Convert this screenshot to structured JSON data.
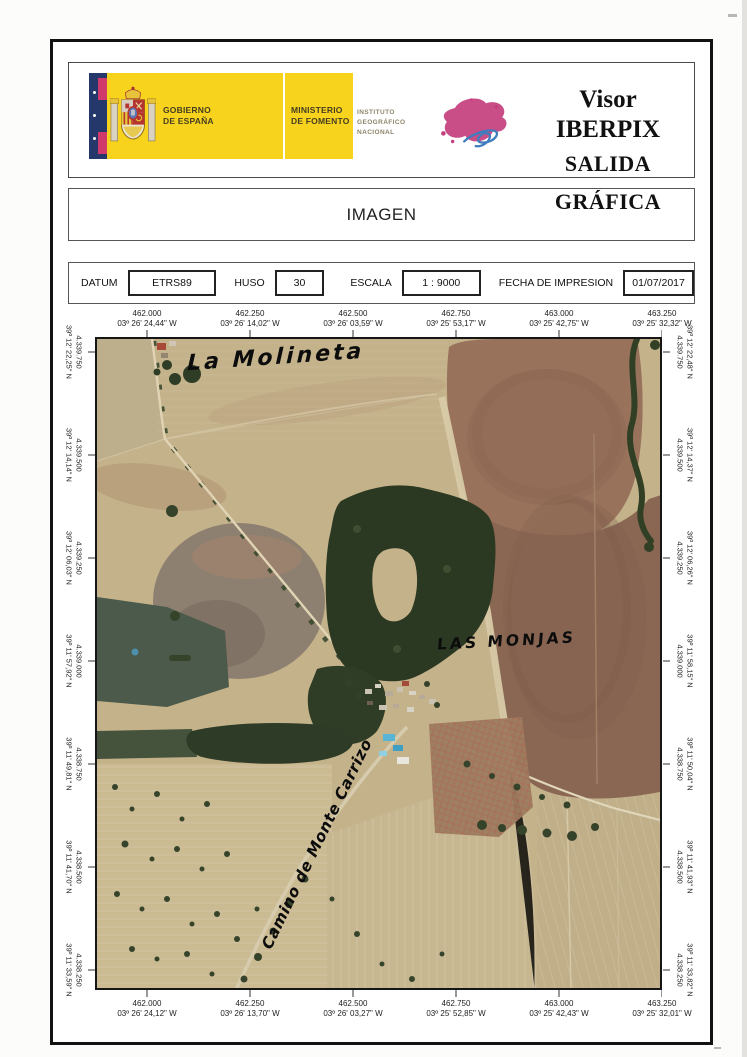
{
  "header": {
    "gobierno_line1": "GOBIERNO",
    "gobierno_line2": "DE ESPAÑA",
    "ministerio_line1": "MINISTERIO",
    "ministerio_line2": "DE FOMENTO",
    "instituto_line1": "INSTITUTO",
    "instituto_line2": "GEOGRÁFICO",
    "instituto_line3": "NACIONAL",
    "title_line1": "Visor IBERPIX",
    "title_line2": "SALIDA GRÁFICA"
  },
  "section": {
    "label": "IMAGEN"
  },
  "metadata": {
    "datum_label": "DATUM",
    "datum_value": "ETRS89",
    "huso_label": "HUSO",
    "huso_value": "30",
    "escala_label": "ESCALA",
    "escala_value": "1 : 9000",
    "fecha_label": "FECHA DE IMPRESION",
    "fecha_value": "01/07/2017"
  },
  "map": {
    "top_labels": [
      {
        "utm": "462.000",
        "geo": "03º 26' 24,44\" W"
      },
      {
        "utm": "462.250",
        "geo": "03º 26' 14,02\" W"
      },
      {
        "utm": "462.500",
        "geo": "03º 26' 03,59\" W"
      },
      {
        "utm": "462.750",
        "geo": "03º 25' 53,17\" W"
      },
      {
        "utm": "463.000",
        "geo": "03º 25' 42,75\" W"
      },
      {
        "utm": "463.250",
        "geo": "03º 25' 32,32\" W"
      }
    ],
    "bottom_labels": [
      {
        "utm": "462.000",
        "geo": "03º 26' 24,12\" W"
      },
      {
        "utm": "462.250",
        "geo": "03º 26' 13,70\" W"
      },
      {
        "utm": "462.500",
        "geo": "03º 26' 03,27\" W"
      },
      {
        "utm": "462.750",
        "geo": "03º 25' 52,85\" W"
      },
      {
        "utm": "463.000",
        "geo": "03º 25' 42,43\" W"
      },
      {
        "utm": "463.250",
        "geo": "03º 25' 32,01\" W"
      }
    ],
    "left_labels": [
      {
        "utm": "4.339.750",
        "geo": "39º 12' 22,25\" N"
      },
      {
        "utm": "4.339.500",
        "geo": "39º 12' 14,14\" N"
      },
      {
        "utm": "4.339.250",
        "geo": "39º 12' 06,03\" N"
      },
      {
        "utm": "4.339.000",
        "geo": "39º 11' 57,92\" N"
      },
      {
        "utm": "4.338.750",
        "geo": "39º 11' 49,81\" N"
      },
      {
        "utm": "4.338.500",
        "geo": "39º 11' 41,70\" N"
      },
      {
        "utm": "4.338.250",
        "geo": "39º 11' 33,59\" N"
      }
    ],
    "right_labels": [
      {
        "utm": "4.339.750",
        "geo": "39º 12' 22,48\" N"
      },
      {
        "utm": "4.339.500",
        "geo": "39º 12' 14,37\" N"
      },
      {
        "utm": "4.339.250",
        "geo": "39º 12' 06,26\" N"
      },
      {
        "utm": "4.339.000",
        "geo": "39º 11' 58,15\" N"
      },
      {
        "utm": "4.338.750",
        "geo": "39º 11' 50,04\" N"
      },
      {
        "utm": "4.338.500",
        "geo": "39º 11' 41,93\" N"
      },
      {
        "utm": "4.338.250",
        "geo": "39º 11' 33,82\" N"
      }
    ],
    "annotations": {
      "place_top": "La Molineta",
      "place_center": "LAS MONJAS",
      "road": "Camino de Monte Carrizo"
    }
  },
  "colors": {
    "brand_yellow": "#f8d31e",
    "flag_navy": "#25386b",
    "flag_crimson": "#cf3a6a",
    "ign_magenta": "#c5407e",
    "ign_blue": "#3f7dbe",
    "frame_black": "#121212"
  }
}
